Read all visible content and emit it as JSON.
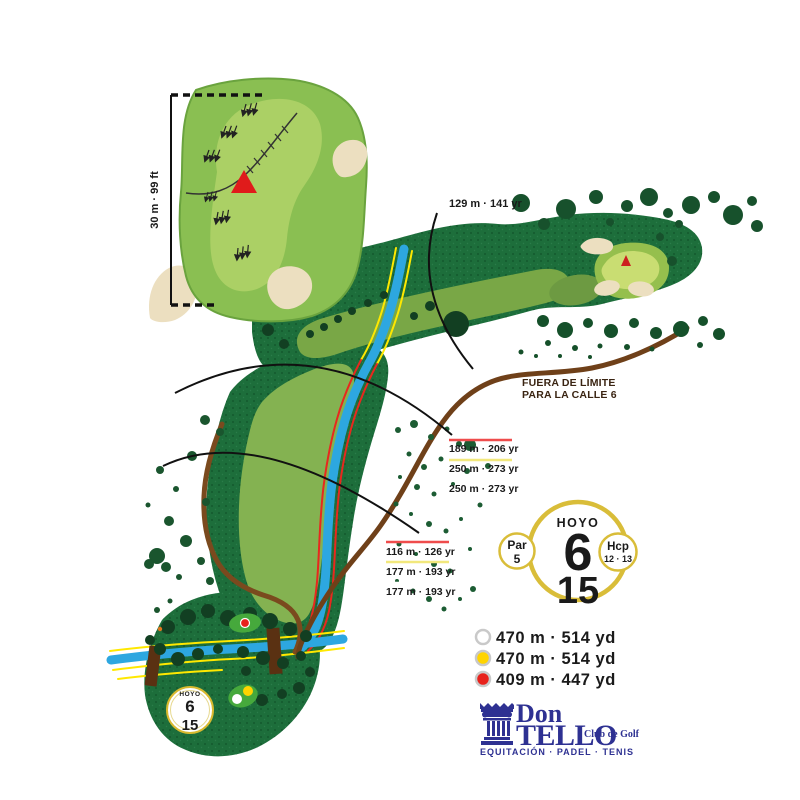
{
  "inset": {
    "scale_label": "30 m · 99 ft"
  },
  "labels": {
    "d129": "129 m · 141 yr",
    "oob_line1": "FUERA DE LÍMITE",
    "oob_line2": "PARA LA CALLE 6"
  },
  "marker_groups": {
    "group1": {
      "red": "189 m · 206 yr",
      "yellow": "250 m · 273 yr",
      "white": "250 m · 273 yr"
    },
    "group2": {
      "red": "116 m · 126 yr",
      "yellow": "177 m · 193 yr",
      "white": "177 m · 193 yr"
    }
  },
  "hole_badge": {
    "title": "HOYO",
    "number": "6",
    "handicap": "15",
    "par_label": "Par",
    "par_value": "5",
    "hcp_label": "Hcp",
    "hcp_value": "12 · 13"
  },
  "mini_badge": {
    "title": "HOYO",
    "number": "6",
    "handicap": "15"
  },
  "tee_legend": [
    {
      "name": "white-tees",
      "color": "#FFFFFF",
      "label": "470 m · 514 yd"
    },
    {
      "name": "yellow-tees",
      "color": "#FFD400",
      "label": "470 m · 514 yd"
    },
    {
      "name": "red-tees",
      "color": "#E8221C",
      "label": "409 m · 447 yd"
    }
  ],
  "logo": {
    "word1": "Don",
    "word2": "TELLO",
    "suffix": "Club de Golf",
    "tagline": "EQUITACIÓN · PADEL · TENIS"
  },
  "colors": {
    "badge_gold": "#D9BD39",
    "logo_blue": "#2E3192",
    "rough_green": "#1D6E3B",
    "fairway_green": "#84B251",
    "water_blue": "#2DA7E0",
    "path_brown": "#7A4A1E",
    "oob_text_brown": "#3A2412"
  }
}
